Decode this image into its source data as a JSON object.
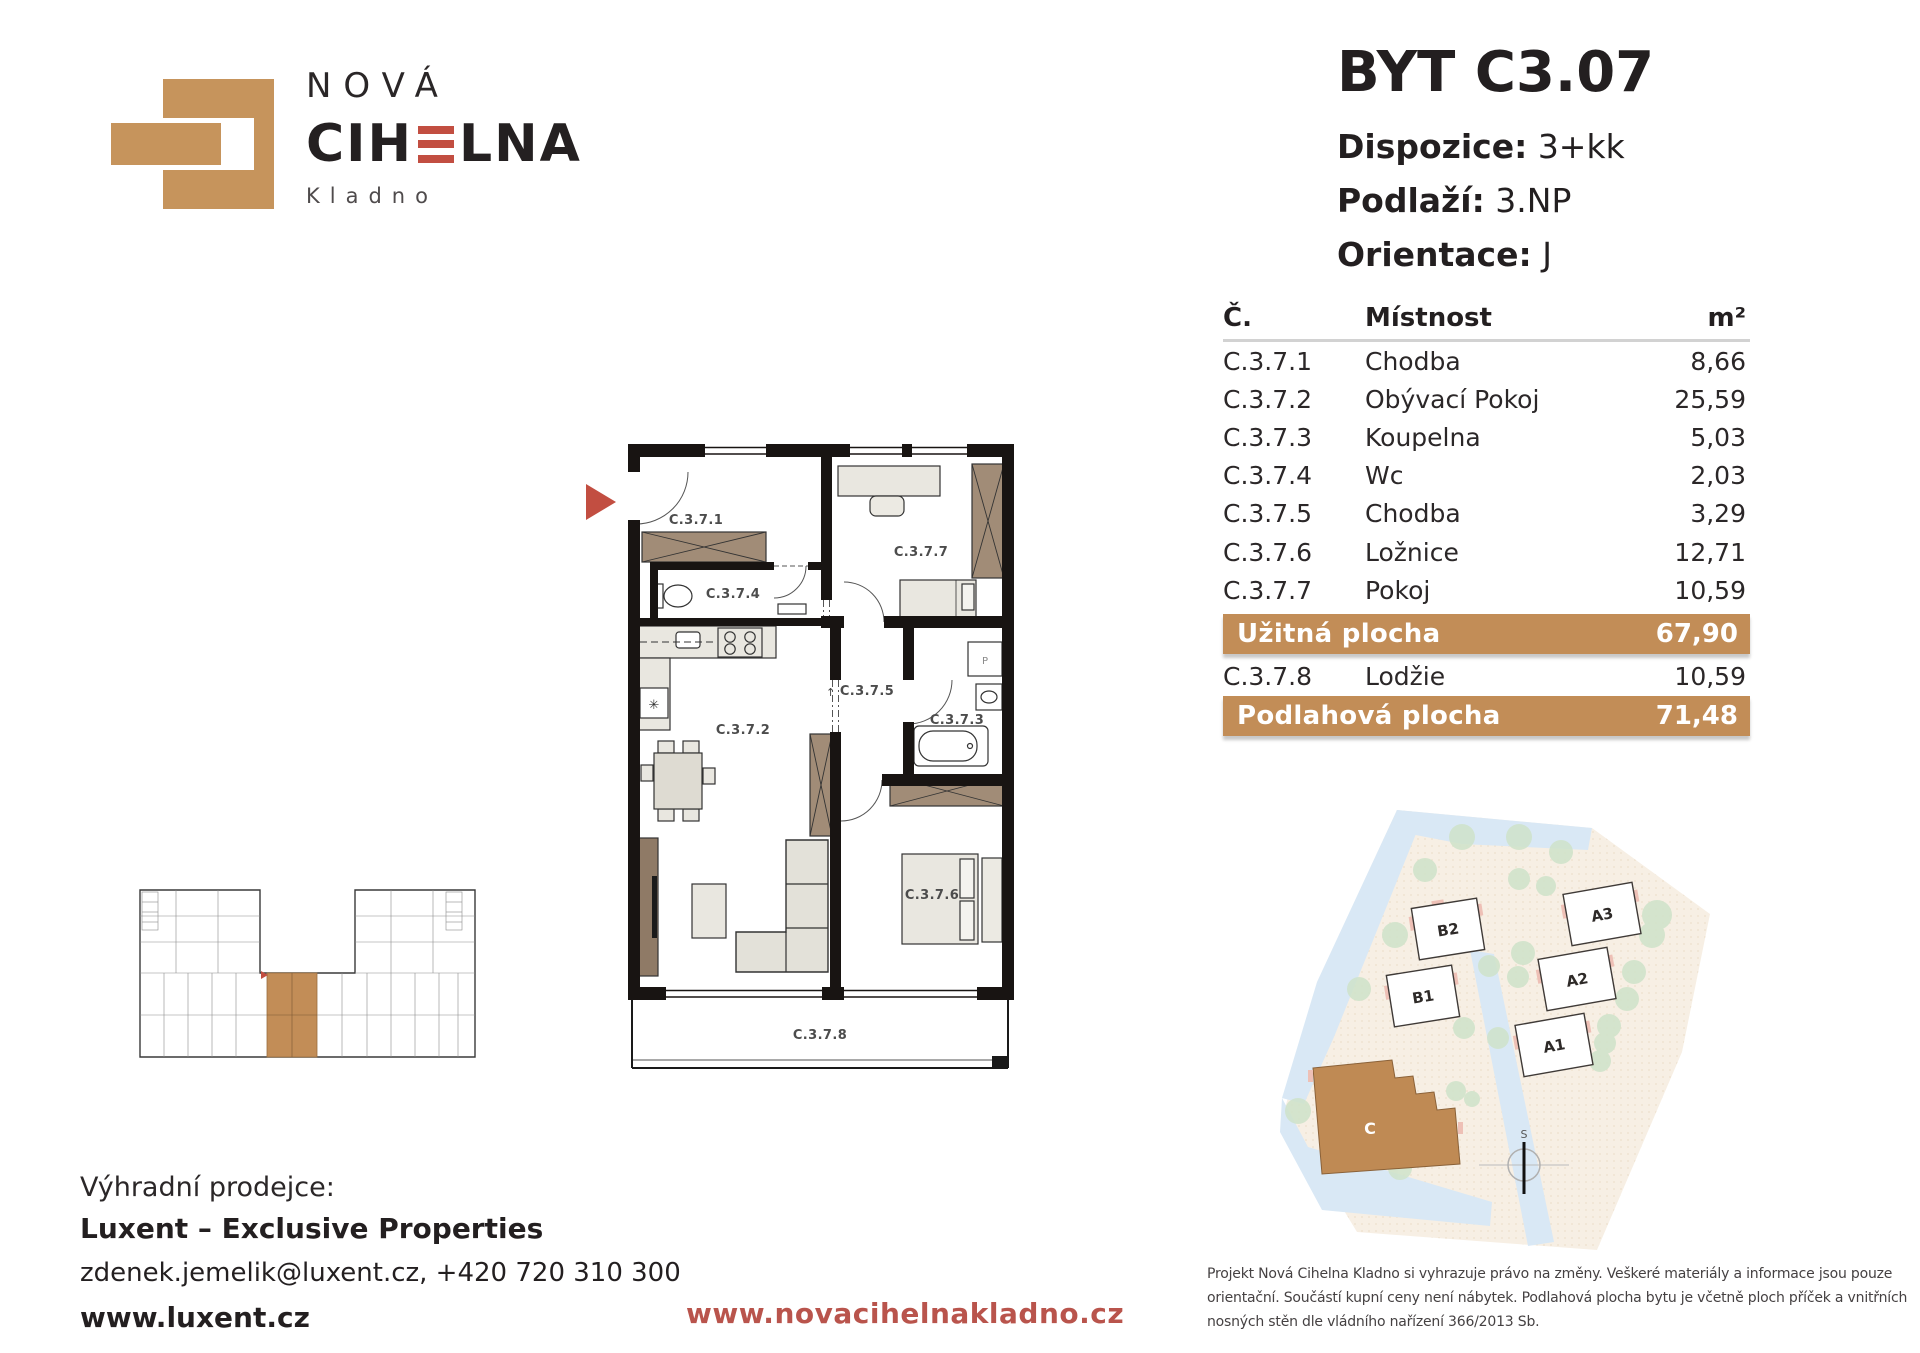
{
  "colors": {
    "tan": "#c28d57",
    "brick": "#c6945c",
    "red_accent": "#c24e41",
    "red_link": "#b9544c",
    "text": "#231f20"
  },
  "logo": {
    "line1": "NOVÁ",
    "word_pre": "CIH",
    "word_post": "LNA",
    "city": "Kladno"
  },
  "header": {
    "title": "BYT C3.07",
    "rows": [
      {
        "label": "Dispozice:",
        "value": "3+kk"
      },
      {
        "label": "Podlaží:",
        "value": "3.NP"
      },
      {
        "label": "Orientace:",
        "value": "J"
      }
    ]
  },
  "table": {
    "col_num": "Č.",
    "col_room": "Místnost",
    "col_area": "m²",
    "rows": [
      {
        "num": "C.3.7.1",
        "room": "Chodba",
        "area": "8,66"
      },
      {
        "num": "C.3.7.2",
        "room": "Obývací Pokoj",
        "area": "25,59"
      },
      {
        "num": "C.3.7.3",
        "room": "Koupelna",
        "area": "5,03"
      },
      {
        "num": "C.3.7.4",
        "room": "Wc",
        "area": "2,03"
      },
      {
        "num": "C.3.7.5",
        "room": "Chodba",
        "area": "3,29"
      },
      {
        "num": "C.3.7.6",
        "room": "Ložnice",
        "area": "12,71"
      },
      {
        "num": "C.3.7.7",
        "room": "Pokoj",
        "area": "10,59"
      }
    ],
    "usable": {
      "label": "Užitná plocha",
      "value": "67,90"
    },
    "extra_row": {
      "num": "C.3.7.8",
      "room": "Lodžie",
      "area": "10,59"
    },
    "floor": {
      "label": "Podlahová plocha",
      "value": "71,48"
    }
  },
  "plan": {
    "rooms": {
      "r1": "C.3.7.1",
      "r2": "C.3.7.2",
      "r3": "C.3.7.3",
      "r4": "C.3.7.4",
      "r5": "C.3.7.5",
      "r6": "C.3.7.6",
      "r7": "C.3.7.7",
      "r8": "C.3.7.8"
    },
    "washer": "P"
  },
  "siteplan": {
    "b2": "B2",
    "b1": "B1",
    "a3": "A3",
    "a2": "A2",
    "a1": "A1",
    "c": "C",
    "compass": "S"
  },
  "footer": {
    "seller_label": "Výhradní prodejce:",
    "seller_name": "Luxent – Exclusive Properties",
    "seller_contact": "zdenek.jemelik@luxent.cz, +420 720 310 300",
    "seller_web": "www.luxent.cz",
    "project_web": "www.novacihelnakladno.cz",
    "disclaimer_lines": [
      "Projekt Nová Cihelna Kladno si vyhrazuje právo na změny. Veškeré materiály a informace jsou pouze",
      "orientační. Součástí kupní ceny není nábytek. Podlahová plocha bytu je včetně ploch příček a vnitřních",
      "nosných stěn dle vládního nařízení 366/2013 Sb."
    ]
  }
}
